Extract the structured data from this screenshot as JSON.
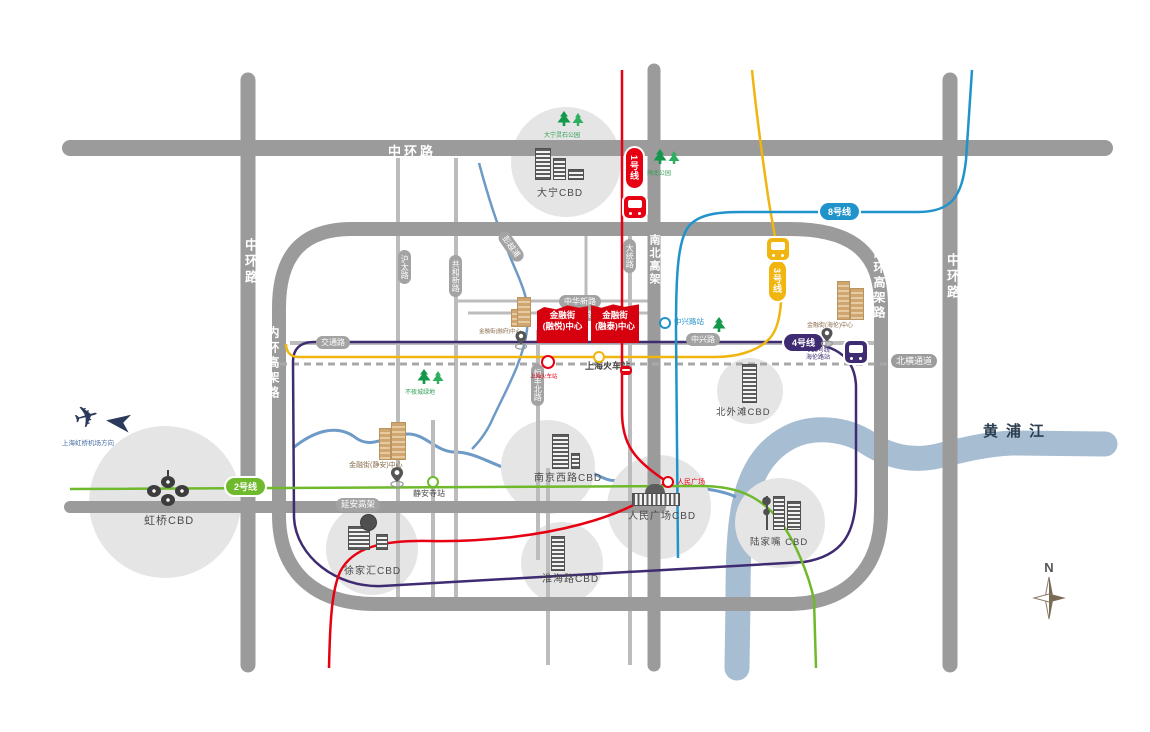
{
  "roads": {
    "zhonghuan_top": "中环路",
    "zhonghuan_left": "中环路",
    "zhonghuan_right": "中环路",
    "neihuan_left": "内环高架路",
    "neihuan_right": "内环高架路",
    "nanbei_gaojia": "南北高架",
    "yanan_gaojia": "延安高架",
    "beiheng_tunnel": "北横通道"
  },
  "road_pills": {
    "jiaotong": "交通路",
    "zhongxing": "中兴路",
    "zhonghuaxin": "中华新路",
    "yutong": "裕通路",
    "pengyuepu": "彭越浦",
    "hutai": "沪太路",
    "gonghexin": "共和新路",
    "datong": "大统路",
    "hengfengbei": "恒丰北路"
  },
  "metro": {
    "line1": {
      "label": "1号线",
      "color": "#e60012"
    },
    "line2": {
      "label": "2号线",
      "color": "#6fb92c"
    },
    "line3": {
      "label": "3号线",
      "color": "#f0b50e"
    },
    "line4": {
      "label": "4号线",
      "color": "#3f2b71"
    },
    "line8": {
      "label": "8号线",
      "color": "#2193cb"
    }
  },
  "stations": {
    "zhongxinglu": "中兴路站",
    "railway_tiny": "上海火车站",
    "railway": "上海火车站",
    "renmin_guangchang": "人民广场",
    "jingansi": "静安寺站",
    "hailun_lines": "4/10号线",
    "hailun_station": "海伦路站"
  },
  "cbds": {
    "daning": "大宁CBD",
    "hongqiao": "虹桥CBD",
    "xujiahui": "徐家汇CBD",
    "huaihai": "淮海路CBD",
    "nanjingxilu": "南京西路CBD",
    "renmin": "人民广场CBD",
    "beiwaitan": "北外滩CBD",
    "lujiazui": "陆家嘴 CBD"
  },
  "project": {
    "block_a_line1": "金融街",
    "block_a_line2": "(融悦)中心",
    "block_b_line1": "金融街",
    "block_b_line2": "(融泰)中心",
    "jingan_center": "金融街(静安)中心",
    "hailun_center": "金融街(海伦)中心",
    "rongfu_center": "金融街(融府)中心"
  },
  "parks": {
    "daning_lingshi": "大宁灵石公园",
    "zhabei": "闸北公园",
    "buyecheng": "不夜城绿地"
  },
  "river": {
    "label": "黄浦江",
    "color": "#a7bdd2",
    "creek_color": "#6d9ac6"
  },
  "airport": {
    "label": "上海虹桥机场方向"
  },
  "compass": {
    "label": "N"
  },
  "colors": {
    "road": "#9b9b9b",
    "minor_road": "#bcbcbc",
    "railway": "#a8a8a8",
    "project_red": "#d6000f",
    "building_tan": "#8a6d4a",
    "park_green": "#2f9e54",
    "circle_gray": "#e5e5e5",
    "airport_navy": "#2b3a5c"
  }
}
